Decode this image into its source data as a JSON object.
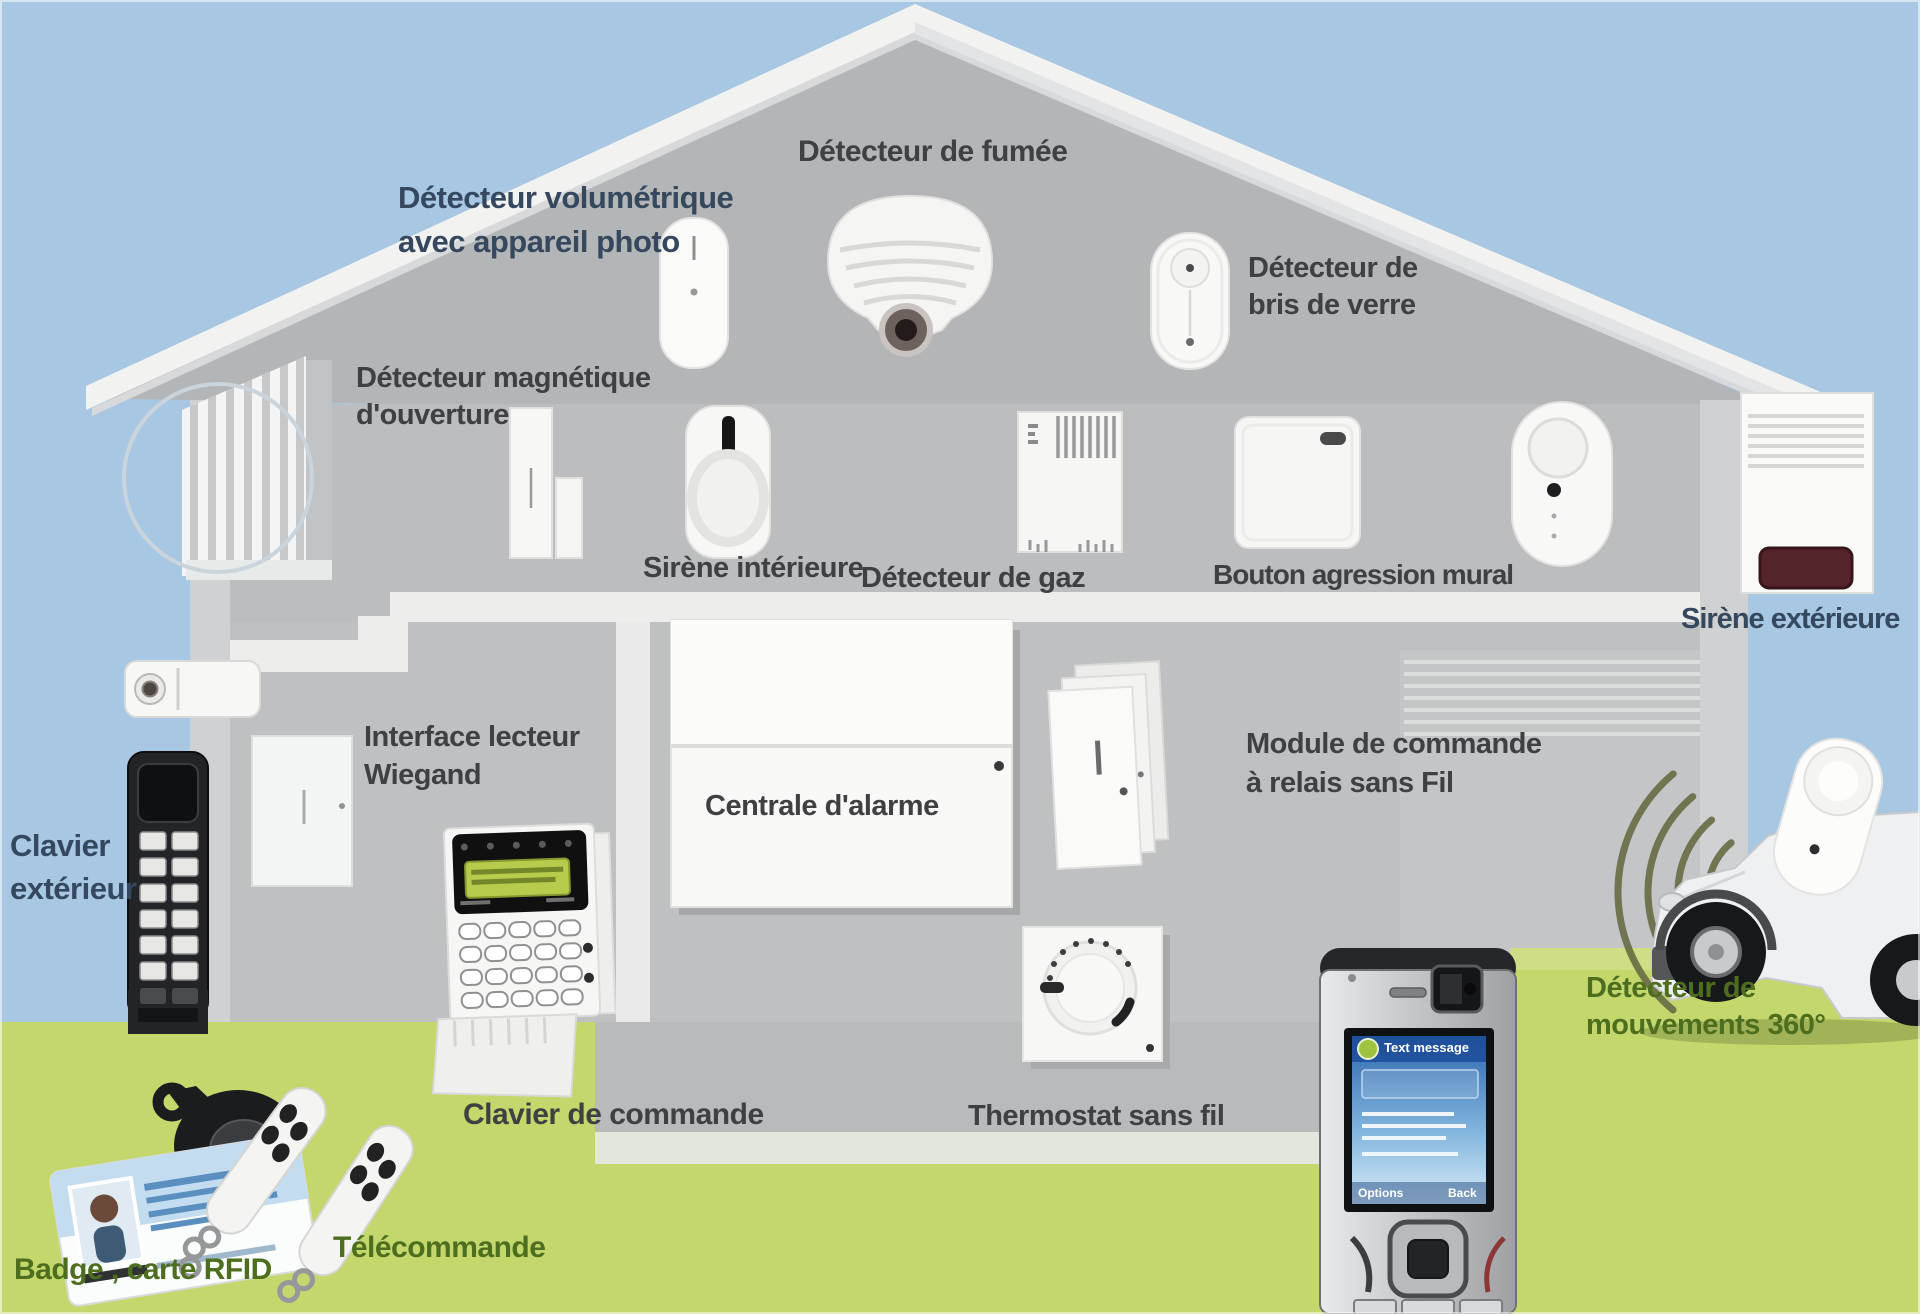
{
  "diagram": {
    "type": "home-alarm-system-overview",
    "language": "fr"
  },
  "palette": {
    "sky": "#a8c7e3",
    "grass": "#c3d76c",
    "house_wall": "#bcbdbe",
    "house_gable": "#b4b5b7",
    "roof": "#f2f2f1",
    "label_dark": "#3f4041",
    "label_blue": "#35485e",
    "label_green": "#4d6e1e",
    "lcd_green": "#b7cc4d",
    "siren_red": "#55232a",
    "phone_screen_blue": "#2d66ad",
    "wifi_wave_olive": "#686c44"
  },
  "labels": {
    "volumetric": {
      "lines": [
        "Détecteur volumétrique",
        "avec appareil photo"
      ]
    },
    "smoke": {
      "text": "Détecteur de fumée"
    },
    "glassbreak": {
      "lines": [
        "Détecteur de",
        "bris de verre"
      ]
    },
    "magnetic": {
      "lines": [
        "Détecteur magnétique",
        "d'ouverture"
      ]
    },
    "indoor_siren": {
      "text": "Sirène intérieure"
    },
    "gas": {
      "text": "Détecteur de gaz"
    },
    "panic_button": {
      "text": "Bouton agression mural"
    },
    "outdoor_siren": {
      "text": "Sirène extérieure"
    },
    "wiegand": {
      "lines": [
        "Interface lecteur",
        "Wiegand"
      ]
    },
    "panel": {
      "text": "Centrale d'alarme"
    },
    "relay_module": {
      "lines": [
        "Module de commande",
        "à relais sans Fil"
      ]
    },
    "outdoor_keypad": {
      "lines": [
        "Clavier",
        "extérieur"
      ]
    },
    "command_keypad": {
      "text": "Clavier de commande"
    },
    "thermostat": {
      "text": "Thermostat sans fil"
    },
    "badge": {
      "text": "Badge , carte RFID"
    },
    "remote": {
      "text": "Télécommande"
    },
    "motion360": {
      "lines": [
        "Détecteur de",
        "mouvements 360°"
      ]
    }
  },
  "phone": {
    "header": "Text message",
    "softkey_left": "Options",
    "softkey_right": "Back"
  },
  "devices": [
    "volumetric-detector",
    "smoke-detector",
    "glass-break-detector",
    "magnetic-opening-detector",
    "indoor-siren",
    "gas-detector",
    "wall-panic-button",
    "oval-button-device",
    "outdoor-siren",
    "badge-reader",
    "outdoor-keypad",
    "command-keypad",
    "alarm-panel",
    "relay-module",
    "thermostat-device",
    "mobile-phone",
    "motion-detector-360",
    "wifi-waves",
    "rfid-badge-card",
    "remote-keyfobs",
    "car",
    "window-shutters",
    "interior-door"
  ]
}
